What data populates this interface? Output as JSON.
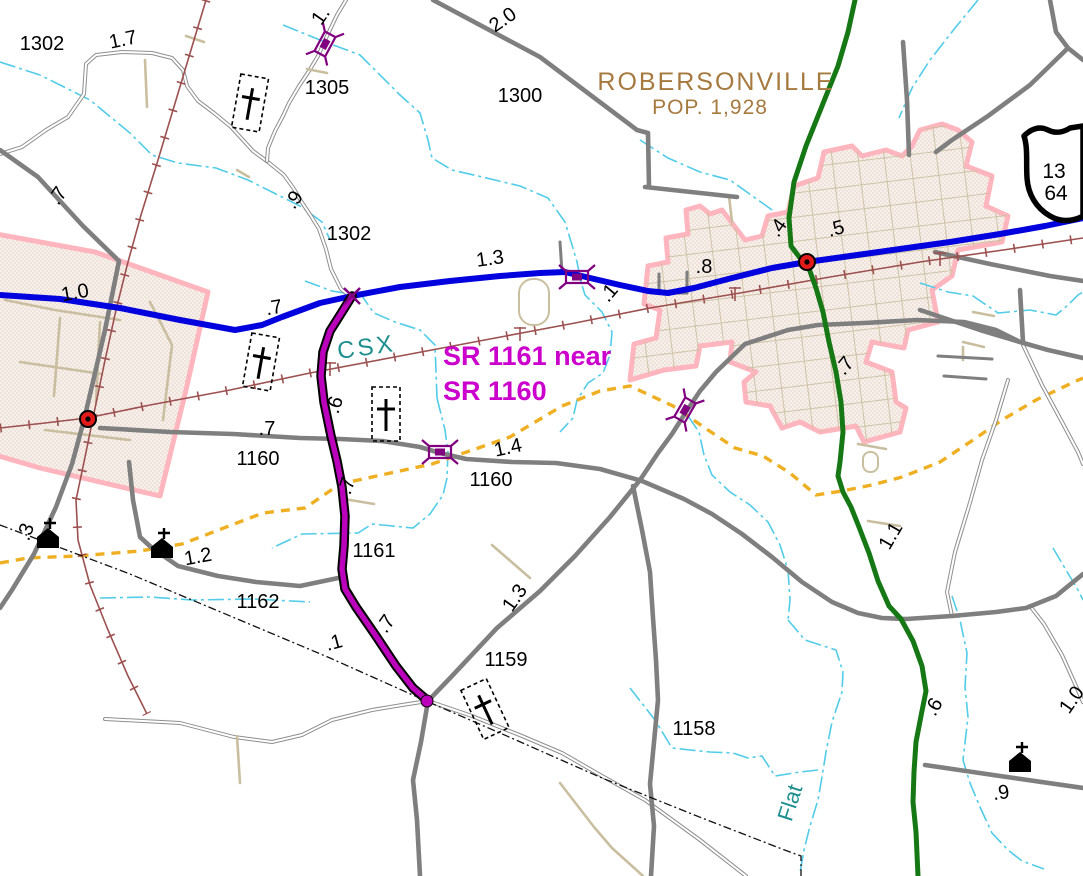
{
  "map": {
    "town": {
      "name": "ROBERSONVILLE",
      "pop": "POP. 1,928"
    },
    "callout": {
      "line1": "SR 1161 near",
      "line2": "SR 1160"
    },
    "railroad_name": "CSX",
    "stream_name": "Flat",
    "shield": {
      "top": "13",
      "bottom": "64"
    },
    "labels": [
      {
        "text": "1302",
        "x": 42,
        "y": 44,
        "rot": 0
      },
      {
        "text": "1.7",
        "x": 123,
        "y": 40,
        "rot": -12
      },
      {
        "text": "1.",
        "x": 321,
        "y": 16,
        "rot": -55
      },
      {
        "text": "1305",
        "x": 327,
        "y": 88,
        "rot": 0
      },
      {
        "text": "2.0",
        "x": 503,
        "y": 20,
        "rot": -35
      },
      {
        "text": "1300",
        "x": 520,
        "y": 96,
        "rot": 0
      },
      {
        "text": "1302",
        "x": 349,
        "y": 234,
        "rot": 0
      },
      {
        "text": ".9",
        "x": 294,
        "y": 200,
        "rot": -55
      },
      {
        "text": ".7",
        "x": 58,
        "y": 196,
        "rot": -55
      },
      {
        "text": "1.0",
        "x": 75,
        "y": 293,
        "rot": -10
      },
      {
        "text": ".7",
        "x": 274,
        "y": 308,
        "rot": -10
      },
      {
        "text": "1.3",
        "x": 490,
        "y": 259,
        "rot": -8
      },
      {
        "text": ".1",
        "x": 609,
        "y": 293,
        "rot": -50
      },
      {
        "text": ".8",
        "x": 704,
        "y": 267,
        "rot": 0
      },
      {
        "text": ".4",
        "x": 778,
        "y": 228,
        "rot": -55
      },
      {
        "text": ".5",
        "x": 836,
        "y": 229,
        "rot": -15
      },
      {
        "text": ".7",
        "x": 845,
        "y": 366,
        "rot": -50
      },
      {
        "text": ".7",
        "x": 267,
        "y": 429,
        "rot": 0
      },
      {
        "text": "1160",
        "x": 258,
        "y": 459,
        "rot": 0
      },
      {
        "text": ".6",
        "x": 335,
        "y": 405,
        "rot": -72
      },
      {
        "text": "1.4",
        "x": 508,
        "y": 448,
        "rot": -12
      },
      {
        "text": "1160",
        "x": 491,
        "y": 480,
        "rot": 0
      },
      {
        "text": ".7",
        "x": 347,
        "y": 486,
        "rot": -72
      },
      {
        "text": "1161",
        "x": 374,
        "y": 551,
        "rot": 0
      },
      {
        "text": "1162",
        "x": 258,
        "y": 602,
        "rot": 0
      },
      {
        "text": ".1",
        "x": 334,
        "y": 643,
        "rot": -15
      },
      {
        "text": ".7",
        "x": 386,
        "y": 624,
        "rot": -55
      },
      {
        "text": "1.3",
        "x": 515,
        "y": 598,
        "rot": -55
      },
      {
        "text": "1159",
        "x": 506,
        "y": 660,
        "rot": 0
      },
      {
        "text": "1158",
        "x": 694,
        "y": 729,
        "rot": 0
      },
      {
        "text": "1.1",
        "x": 891,
        "y": 536,
        "rot": -60
      },
      {
        "text": ".6",
        "x": 934,
        "y": 707,
        "rot": -60
      },
      {
        "text": "1.0",
        "x": 1072,
        "y": 700,
        "rot": -55
      },
      {
        "text": ".9",
        "x": 1001,
        "y": 793,
        "rot": -8
      },
      {
        "text": ".3",
        "x": 26,
        "y": 532,
        "rot": -70
      },
      {
        "text": "1.2",
        "x": 198,
        "y": 557,
        "rot": -10
      }
    ]
  },
  "colors": {
    "blue_route": "#0202DE",
    "green_route": "#157815",
    "highlight_route": "#BB00BB",
    "road_gray": "#7F7F7F",
    "road_tan": "#C9BFA0",
    "railroad": "#9C5050",
    "stream": "#52CCE8",
    "boundary_pink": "#FFB5BD",
    "town_fill": "#F8F1EA",
    "town_dots": "#CBA8A8",
    "powerline_yellow": "#EFAF22",
    "label_black": "#000000",
    "town_label_brown": "#A6793F",
    "rail_label_teal": "#1E8F8F",
    "callout_magenta": "#CC00CC",
    "marker_red": "#E31A1A",
    "bridge_purple": "#800080"
  }
}
